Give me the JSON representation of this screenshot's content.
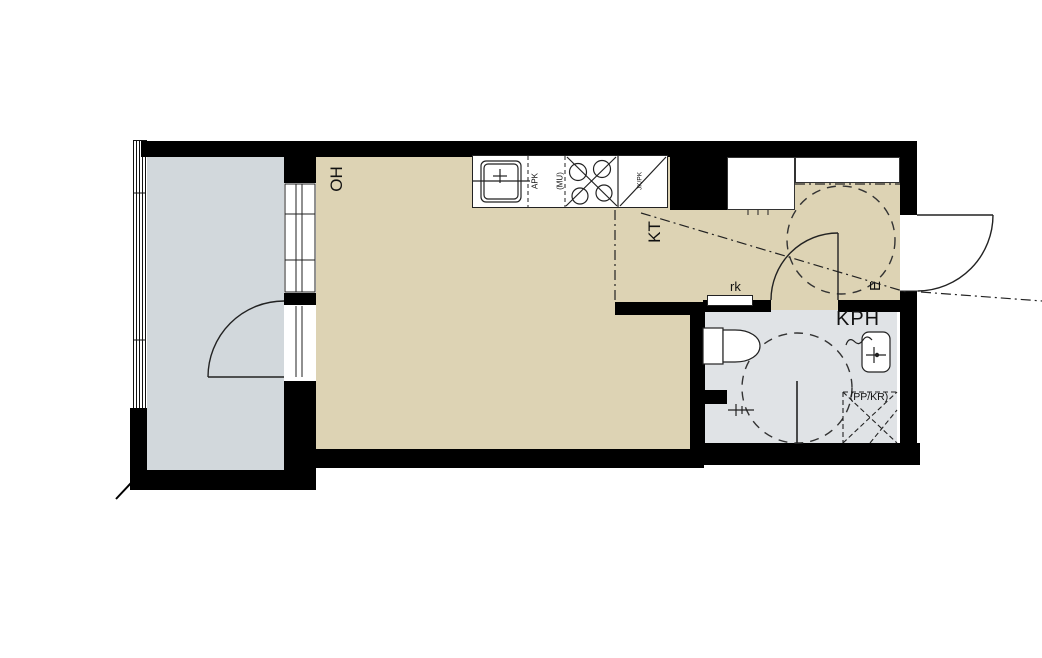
{
  "labels": {
    "living": "OH",
    "kitchen": "KT",
    "entry": "E",
    "bathroom": "KPH",
    "closet": "rk",
    "dishwasher_line1": "APK",
    "dishwasher_line2": "(MU)",
    "tall_cabinet": "JK/PK",
    "laundry_reservation": "(PP/KR)"
  },
  "colors": {
    "wall": "#000000",
    "floor_main": "#ddd3b4",
    "floor_balcony": "#d2d8dc",
    "floor_bath": "#e0e3e6",
    "line": "#222222",
    "canvas": "#ffffff"
  }
}
